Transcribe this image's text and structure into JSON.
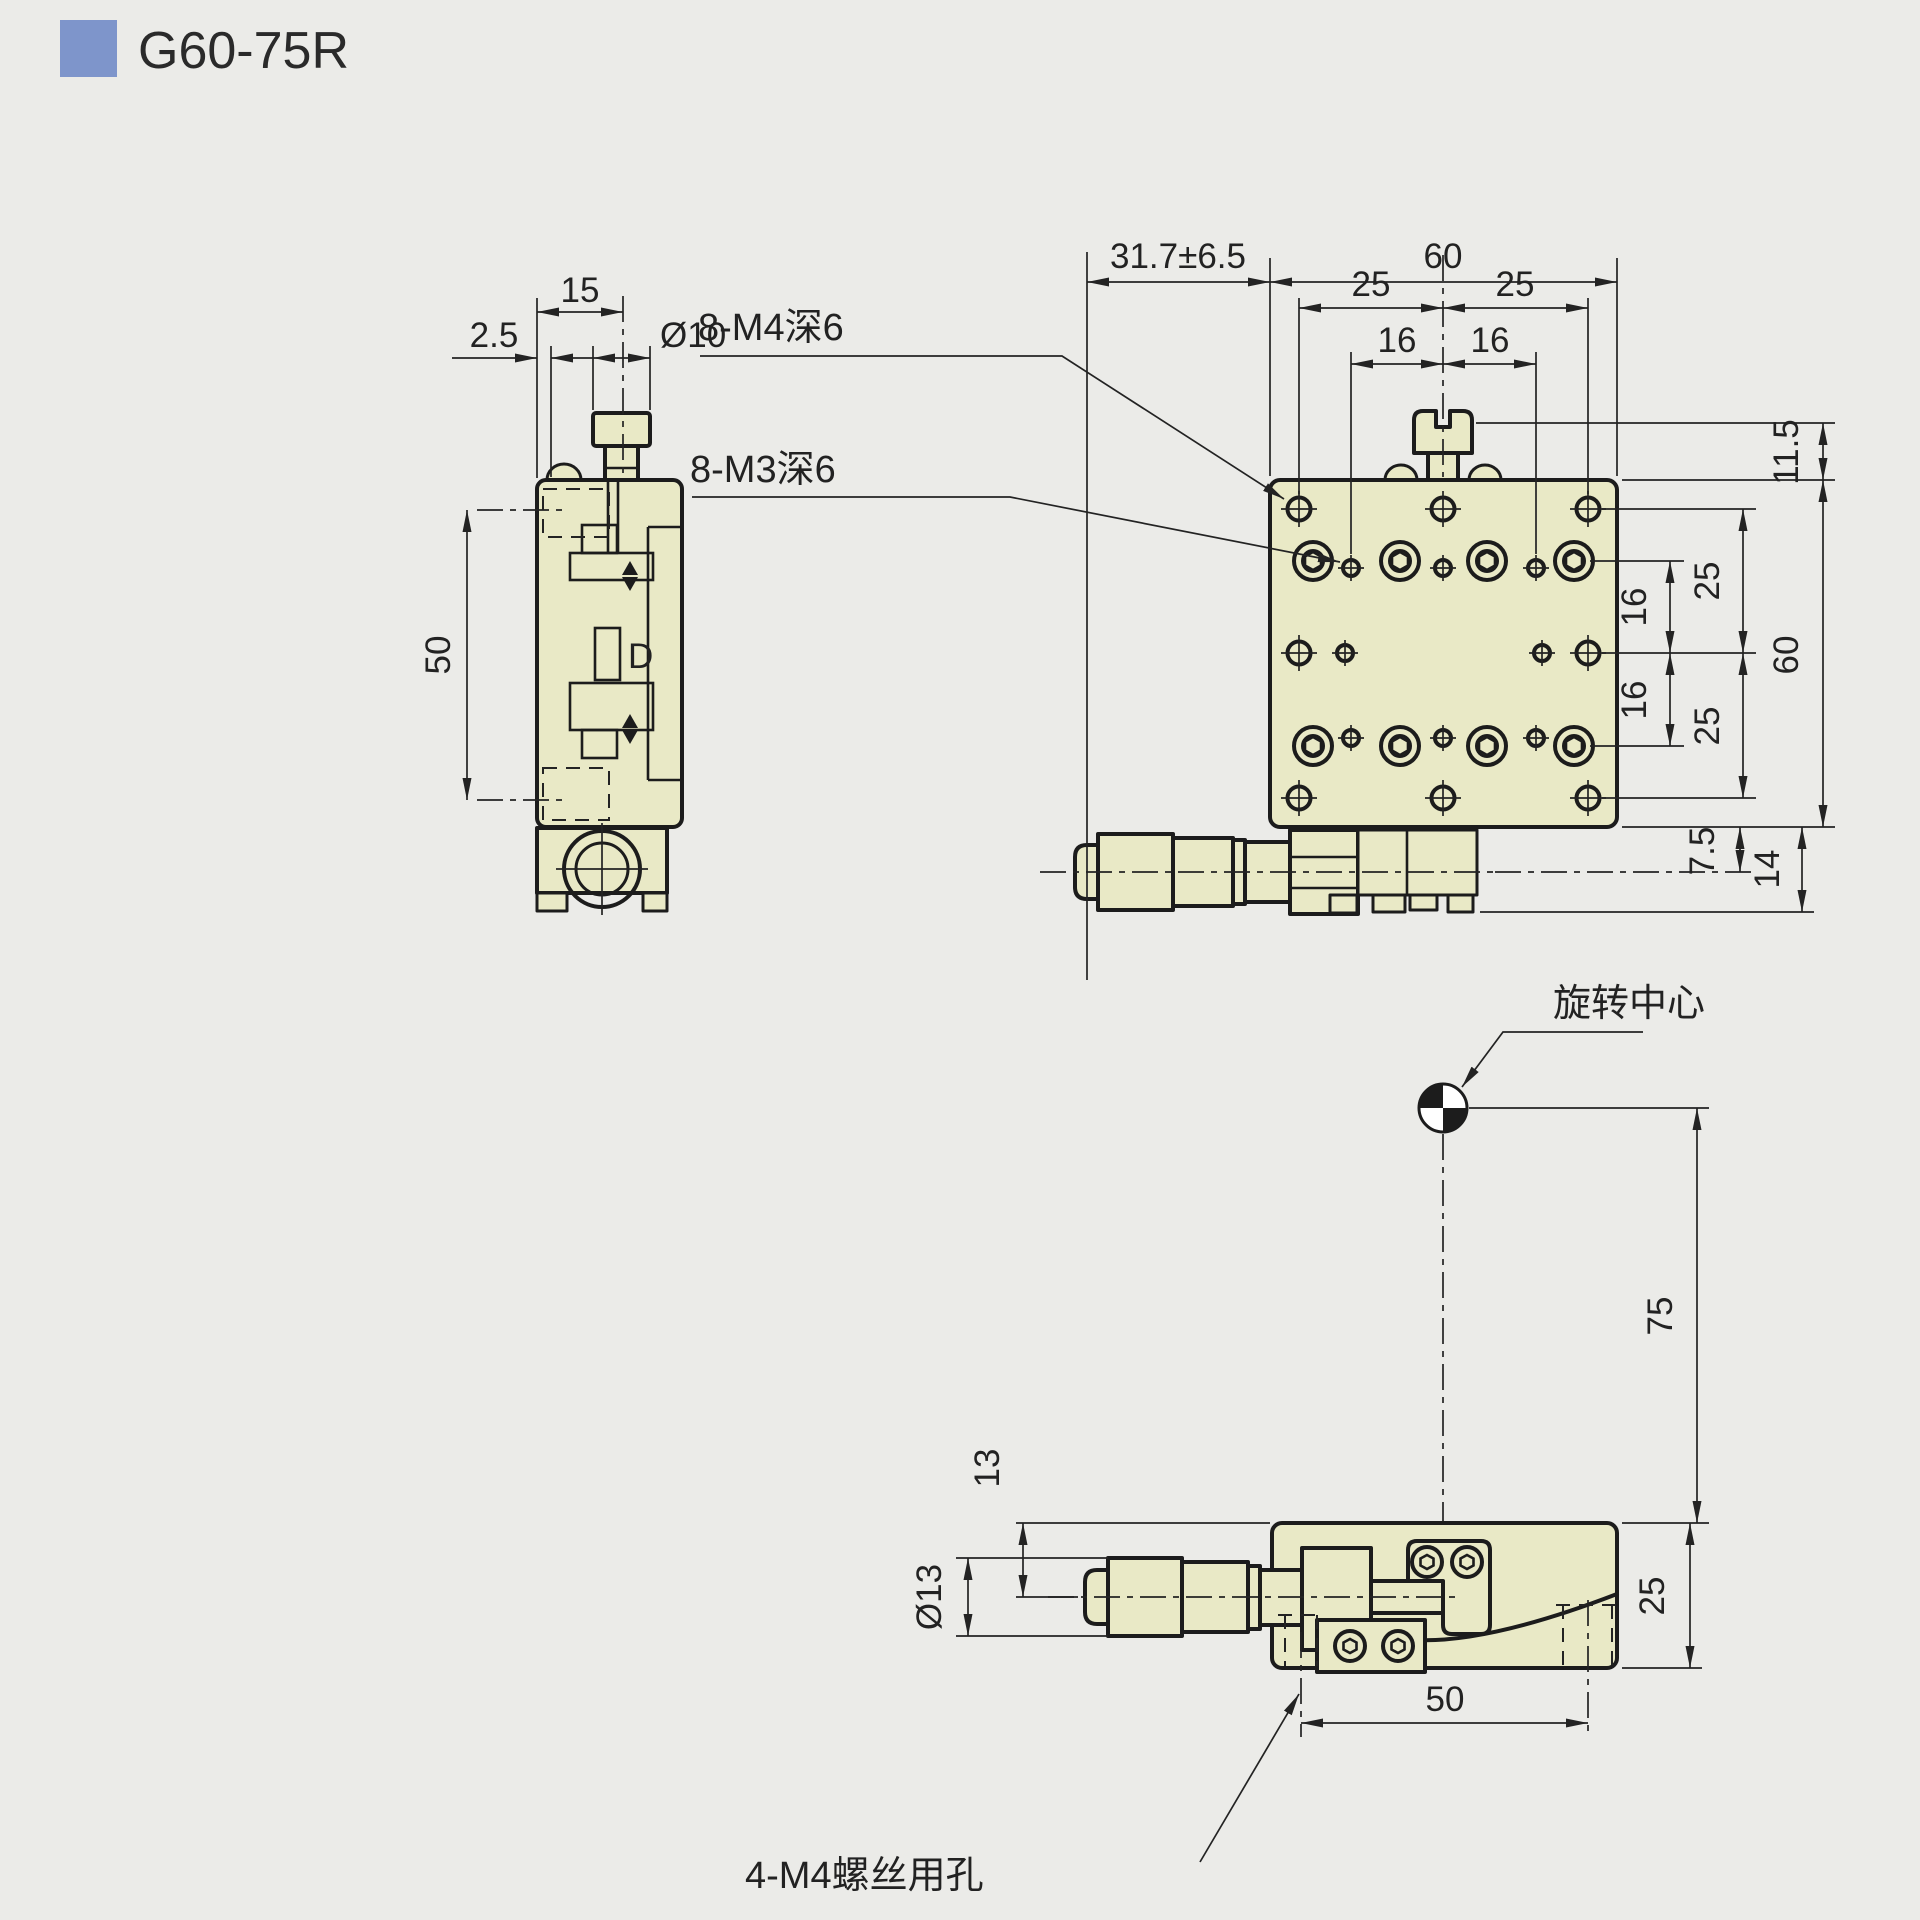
{
  "title": {
    "model": "G60-75R"
  },
  "colors": {
    "accent_blue": "#7e95cb",
    "part_fill": "#e9e9c6",
    "line": "#1c1c1c",
    "background": "#ebebe8"
  },
  "side_view": {
    "dim_top_width": "15",
    "dim_edge_offset": "2.5",
    "dim_knob_dia": "Ø10",
    "dim_travel_span": "50",
    "label_detail": "D"
  },
  "top_view": {
    "dim_micrometer_travel": "31.7±6.5",
    "dim_width": "60",
    "dim_col_25_left": "25",
    "dim_col_25_right": "25",
    "dim_col_16_left": "16",
    "dim_col_16_right": "16",
    "dim_knob_height": "11.5",
    "dim_row_25_top": "25",
    "dim_row_16_top": "16",
    "dim_row_16_bottom": "16",
    "dim_row_25_bottom": "25",
    "dim_height": "60",
    "dim_base_offset": "7.5",
    "dim_base_height": "14",
    "label_m4_holes": "8-M4深6",
    "label_m3_holes": "8-M3深6"
  },
  "front_view": {
    "dim_axis_offset": "13",
    "dim_micrometer_dia": "Ø13",
    "dim_height": "25",
    "dim_hole_span": "50",
    "dim_rotation_radius": "75",
    "label_rotation_center": "旋转中心",
    "label_m4_clearance": "4-M4螺丝用孔"
  }
}
